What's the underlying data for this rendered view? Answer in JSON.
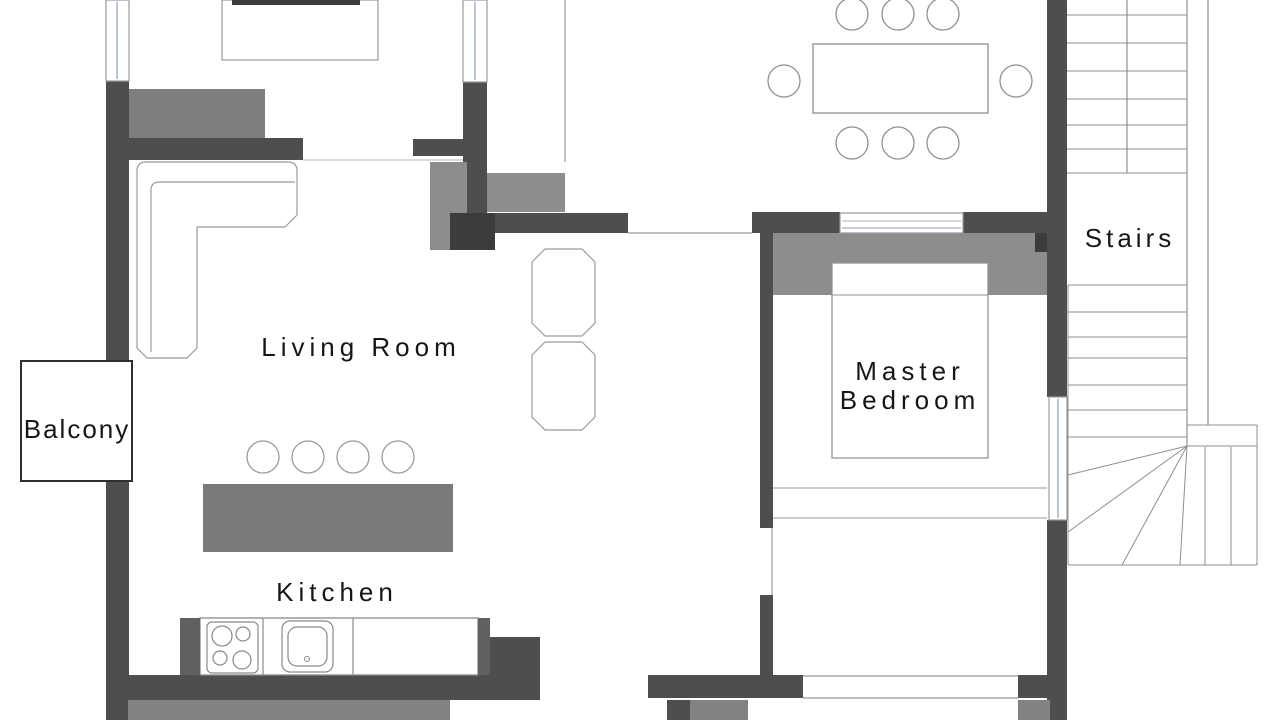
{
  "meta": {
    "width": 1280,
    "height": 720,
    "background": "#ffffff",
    "type": "architectural-floor-plan"
  },
  "rooms": [
    "Living Room",
    "Balcony",
    "Kitchen",
    "Master Bedroom",
    "Stairs"
  ],
  "colors": {
    "wall": "#4e4e4e",
    "wall_dark": "#3c3c3c",
    "furniture_gray": "#8d8d8d",
    "outline": "#9a9a9a",
    "window_glass": "#9fb0d8",
    "text": "#161616"
  },
  "labels": {
    "living_room": "Living Room",
    "balcony": "Balcony",
    "kitchen": "Kitchen",
    "master_bedroom_line1": "Master",
    "master_bedroom_line2": "Bedroom",
    "stairs": "Stairs"
  },
  "shapes": [
    {
      "t": "rect",
      "n": "sideboard",
      "x": 129,
      "y": 89,
      "w": 136,
      "h": 49,
      "f": "#7e7e7e"
    },
    {
      "t": "rect",
      "n": "wall-left-upper",
      "x": 106,
      "y": 81,
      "w": 23,
      "h": 280,
      "f": "#4e4e4e"
    },
    {
      "t": "rect",
      "n": "wall-left-lower",
      "x": 106,
      "y": 481,
      "w": 23,
      "h": 239,
      "f": "#4e4e4e"
    },
    {
      "t": "rect",
      "n": "wall-top-left-horizontal",
      "x": 129,
      "y": 138,
      "w": 174,
      "h": 22,
      "f": "#4e4e4e"
    },
    {
      "t": "rect",
      "n": "wall-entry-stub",
      "x": 413,
      "y": 139,
      "w": 65,
      "h": 17,
      "f": "#4e4e4e"
    },
    {
      "t": "rect",
      "n": "wall-window-column",
      "x": 463,
      "y": 82,
      "w": 24,
      "h": 131,
      "f": "#4e4e4e"
    },
    {
      "t": "rect",
      "n": "cabinet-junction-left",
      "x": 430,
      "y": 162,
      "w": 37,
      "h": 88,
      "f": "#8d8d8d"
    },
    {
      "t": "rect",
      "n": "cabinet-junction-top",
      "x": 487,
      "y": 173,
      "w": 78,
      "h": 39,
      "f": "#8d8d8d"
    },
    {
      "t": "rect",
      "n": "wall-center-bar",
      "x": 450,
      "y": 213,
      "w": 178,
      "h": 20,
      "f": "#4e4e4e"
    },
    {
      "t": "rect",
      "n": "wall-center-pier",
      "x": 450,
      "y": 213,
      "w": 45,
      "h": 37,
      "f": "#3c3c3c"
    },
    {
      "t": "rect",
      "n": "wall-dining-right",
      "x": 1047,
      "y": 0,
      "w": 20,
      "h": 233,
      "f": "#4e4e4e"
    },
    {
      "t": "rect",
      "n": "wall-bedroom-top-left",
      "x": 752,
      "y": 212,
      "w": 88,
      "h": 21,
      "f": "#4e4e4e"
    },
    {
      "t": "rect",
      "n": "wall-bedroom-top-right",
      "x": 963,
      "y": 212,
      "w": 104,
      "h": 21,
      "f": "#4e4e4e"
    },
    {
      "t": "rect",
      "n": "wardrobe-headboard",
      "x": 773,
      "y": 233,
      "w": 275,
      "h": 62,
      "f": "#8d8d8d"
    },
    {
      "t": "rect",
      "n": "wall-headboard-pier",
      "x": 1035,
      "y": 233,
      "w": 15,
      "h": 19,
      "f": "#3c3c3c"
    },
    {
      "t": "rect",
      "n": "wall-bedroom-left-upper",
      "x": 760,
      "y": 233,
      "w": 13,
      "h": 295,
      "f": "#4e4e4e"
    },
    {
      "t": "rect",
      "n": "wall-bedroom-left-lower",
      "x": 760,
      "y": 595,
      "w": 13,
      "h": 80,
      "f": "#4e4e4e"
    },
    {
      "t": "rect",
      "n": "wall-right-mid",
      "x": 1047,
      "y": 233,
      "w": 20,
      "h": 164,
      "f": "#4e4e4e"
    },
    {
      "t": "rect",
      "n": "wall-right-lower",
      "x": 1047,
      "y": 520,
      "w": 20,
      "h": 200,
      "f": "#4e4e4e"
    },
    {
      "t": "rect",
      "n": "wall-bottom-bedroom-left",
      "x": 648,
      "y": 675,
      "w": 155,
      "h": 23,
      "f": "#4e4e4e"
    },
    {
      "t": "rect",
      "n": "wall-bottom-bedroom-right",
      "x": 1018,
      "y": 675,
      "w": 49,
      "h": 23,
      "f": "#4e4e4e"
    },
    {
      "t": "rect",
      "n": "wall-bottom-kitchen",
      "x": 106,
      "y": 675,
      "w": 434,
      "h": 25,
      "f": "#4e4e4e"
    },
    {
      "t": "rect",
      "n": "wall-kitchen-jog",
      "x": 488,
      "y": 637,
      "w": 52,
      "h": 60,
      "f": "#4e4e4e"
    },
    {
      "t": "rect",
      "n": "wall-gray-band-kitchen",
      "x": 128,
      "y": 700,
      "w": 322,
      "h": 20,
      "f": "#828282"
    },
    {
      "t": "rect",
      "n": "wall-stub-dark",
      "x": 667,
      "y": 700,
      "w": 23,
      "h": 20,
      "f": "#4e4e4e"
    },
    {
      "t": "rect",
      "n": "wall-stub-gray",
      "x": 690,
      "y": 700,
      "w": 58,
      "h": 20,
      "f": "#828282"
    },
    {
      "t": "rect",
      "n": "wall-stub-gray-right",
      "x": 1018,
      "y": 700,
      "w": 32,
      "h": 20,
      "f": "#828282"
    },
    {
      "t": "rect",
      "n": "window-left",
      "x": 106,
      "y": 0,
      "w": 23,
      "h": 81,
      "f": "#ffffff",
      "s": "#9a9a9a",
      "sw": 1.2
    },
    {
      "t": "line",
      "n": "window-left-glass-line",
      "x1": 117,
      "y1": 2,
      "x2": 117,
      "y2": 79,
      "s": "#9fb0d8",
      "sw": 1.5
    },
    {
      "t": "rect",
      "n": "window-top-center",
      "x": 463,
      "y": 0,
      "w": 24,
      "h": 82,
      "f": "#ffffff",
      "s": "#9a9a9a",
      "sw": 1.2
    },
    {
      "t": "line",
      "n": "window-top-center-glass-line",
      "x1": 475,
      "y1": 2,
      "x2": 475,
      "y2": 80,
      "s": "#9fb0d8",
      "sw": 1.5
    },
    {
      "t": "rect",
      "n": "window-bedroom-top",
      "x": 840,
      "y": 213,
      "w": 123,
      "h": 20,
      "f": "#ffffff",
      "s": "#9a9a9a",
      "sw": 1.2
    },
    {
      "t": "line",
      "n": "window-bedroom-top-line",
      "x1": 842,
      "y1": 221,
      "x2": 961,
      "y2": 221,
      "s": "#b0b0b0",
      "sw": 1
    },
    {
      "t": "line",
      "n": "window-bedroom-top-glass-line",
      "x1": 842,
      "y1": 228,
      "x2": 961,
      "y2": 228,
      "s": "#9fb0d8",
      "sw": 1.2
    },
    {
      "t": "rect",
      "n": "window-right",
      "x": 1049,
      "y": 397,
      "w": 18,
      "h": 123,
      "f": "#ffffff",
      "s": "#9a9a9a",
      "sw": 1.2
    },
    {
      "t": "line",
      "n": "window-right-glass-line",
      "x1": 1058,
      "y1": 399,
      "x2": 1058,
      "y2": 518,
      "s": "#9fb0d8",
      "sw": 1.5
    },
    {
      "t": "rect",
      "n": "balcony-outline",
      "x": 21,
      "y": 361,
      "w": 111,
      "h": 120,
      "f": "#ffffff",
      "s": "#2f2f2f",
      "sw": 2
    },
    {
      "t": "line",
      "n": "divider-living-dining",
      "x1": 565,
      "y1": 0,
      "x2": 565,
      "y2": 162,
      "s": "#9a9a9a",
      "sw": 1.2
    },
    {
      "t": "line",
      "n": "opening-top-line",
      "x1": 303,
      "y1": 160,
      "x2": 463,
      "y2": 160,
      "s": "#b5b5b5",
      "sw": 1
    },
    {
      "t": "line",
      "n": "doorway-dining-line",
      "x1": 628,
      "y1": 233,
      "x2": 752,
      "y2": 233,
      "s": "#9a9a9a",
      "sw": 1.2
    },
    {
      "t": "line",
      "n": "door-bedroom-line",
      "x1": 772,
      "y1": 528,
      "x2": 772,
      "y2": 595,
      "s": "#9a9a9a",
      "sw": 1.2
    },
    {
      "t": "line",
      "n": "door-bottom-top-line",
      "x1": 803,
      "y1": 676,
      "x2": 1018,
      "y2": 676,
      "s": "#9a9a9a",
      "sw": 1.2
    },
    {
      "t": "line",
      "n": "door-bottom-bottom-line",
      "x1": 803,
      "y1": 698,
      "x2": 1018,
      "y2": 698,
      "s": "#9a9a9a",
      "sw": 1.2
    },
    {
      "t": "rect",
      "n": "tv-stand",
      "x": 222,
      "y": 0,
      "w": 156,
      "h": 60,
      "f": "#ffffff",
      "s": "#9a9a9a",
      "sw": 1.2
    },
    {
      "t": "rect",
      "n": "tv",
      "x": 232,
      "y": 0,
      "w": 128,
      "h": 5,
      "f": "#3c3c3c"
    },
    {
      "t": "path",
      "n": "sofa-outline",
      "d": "M 137 171 Q 137 162 146 162 L 288 162 Q 297 162 297 171 L 297 215 L 285 227 L 197 227 L 197 348 L 187 358 L 147 358 L 137 348 Z",
      "f": "#ffffff",
      "s": "#9a9a9a",
      "sw": 1.2
    },
    {
      "t": "path",
      "n": "sofa-backrest-line",
      "d": "M 151 352 L 151 190 Q 151 182 160 182 L 295 182",
      "f": "none",
      "s": "#9a9a9a",
      "sw": 1.2
    },
    {
      "t": "path",
      "n": "lounge-chair-1",
      "d": "M 532 262 L 545 249 L 582 249 L 595 262 L 595 323 L 582 336 L 545 336 L 532 323 Z",
      "f": "#ffffff",
      "s": "#9a9a9a",
      "sw": 1.2
    },
    {
      "t": "path",
      "n": "lounge-chair-2",
      "d": "M 532 355 L 545 342 L 582 342 L 595 355 L 595 417 L 582 430 L 545 430 L 532 417 Z",
      "f": "#ffffff",
      "s": "#9a9a9a",
      "sw": 1.2
    },
    {
      "t": "rect",
      "n": "kitchen-island",
      "x": 203,
      "y": 484,
      "w": 250,
      "h": 68,
      "f": "#7a7a7a"
    },
    {
      "t": "circle",
      "n": "bar-stool-1",
      "cx": 263,
      "cy": 457,
      "r": 16,
      "f": "#ffffff",
      "s": "#9a9a9a",
      "sw": 1.3
    },
    {
      "t": "circle",
      "n": "bar-stool-2",
      "cx": 308,
      "cy": 457,
      "r": 16,
      "f": "#ffffff",
      "s": "#9a9a9a",
      "sw": 1.3
    },
    {
      "t": "circle",
      "n": "bar-stool-3",
      "cx": 353,
      "cy": 457,
      "r": 16,
      "f": "#ffffff",
      "s": "#9a9a9a",
      "sw": 1.3
    },
    {
      "t": "circle",
      "n": "bar-stool-4",
      "cx": 398,
      "cy": 457,
      "r": 16,
      "f": "#ffffff",
      "s": "#9a9a9a",
      "sw": 1.3
    },
    {
      "t": "rect",
      "n": "kitchen-counter",
      "x": 200,
      "y": 618,
      "w": 278,
      "h": 57,
      "f": "#ffffff",
      "s": "#8a8a8a",
      "sw": 1.3
    },
    {
      "t": "rect",
      "n": "counter-end-left",
      "x": 180,
      "y": 618,
      "w": 20,
      "h": 57,
      "f": "#606060"
    },
    {
      "t": "rect",
      "n": "counter-end-right",
      "x": 478,
      "y": 618,
      "w": 12,
      "h": 57,
      "f": "#606060"
    },
    {
      "t": "line",
      "n": "counter-divider-1",
      "x1": 263,
      "y1": 618,
      "x2": 263,
      "y2": 675,
      "s": "#8a8a8a",
      "sw": 1.2
    },
    {
      "t": "line",
      "n": "counter-divider-2",
      "x1": 353,
      "y1": 618,
      "x2": 353,
      "y2": 675,
      "s": "#8a8a8a",
      "sw": 1.2
    },
    {
      "t": "rect",
      "n": "stove",
      "x": 207,
      "y": 622,
      "w": 51,
      "h": 51,
      "rx": 5,
      "f": "#ffffff",
      "s": "#8a8a8a",
      "sw": 1.2
    },
    {
      "t": "circle",
      "n": "stove-burner-1",
      "cx": 222,
      "cy": 636,
      "r": 10,
      "f": "none",
      "s": "#8a8a8a",
      "sw": 1.2
    },
    {
      "t": "circle",
      "n": "stove-burner-2",
      "cx": 243,
      "cy": 634,
      "r": 7,
      "f": "none",
      "s": "#8a8a8a",
      "sw": 1.2
    },
    {
      "t": "circle",
      "n": "stove-burner-3",
      "cx": 220,
      "cy": 658,
      "r": 7,
      "f": "none",
      "s": "#8a8a8a",
      "sw": 1.2
    },
    {
      "t": "circle",
      "n": "stove-burner-4",
      "cx": 242,
      "cy": 660,
      "r": 9,
      "f": "none",
      "s": "#8a8a8a",
      "sw": 1.2
    },
    {
      "t": "rect",
      "n": "sink",
      "x": 282,
      "y": 621,
      "w": 51,
      "h": 51,
      "rx": 8,
      "f": "#ffffff",
      "s": "#8a8a8a",
      "sw": 1.2
    },
    {
      "t": "rect",
      "n": "sink-basin",
      "x": 288,
      "y": 627,
      "w": 39,
      "h": 39,
      "rx": 9,
      "f": "none",
      "s": "#8a8a8a",
      "sw": 1.2
    },
    {
      "t": "circle",
      "n": "sink-faucet",
      "cx": 307,
      "cy": 659,
      "r": 2.5,
      "f": "none",
      "s": "#8a8a8a",
      "sw": 1
    },
    {
      "t": "rect",
      "n": "dining-table",
      "x": 813,
      "y": 44,
      "w": 175,
      "h": 69,
      "f": "#ffffff",
      "s": "#8f8f8f",
      "sw": 1.3
    },
    {
      "t": "circle",
      "n": "dining-chair-top-1",
      "cx": 852,
      "cy": 14,
      "r": 16,
      "f": "#ffffff",
      "s": "#8f8f8f",
      "sw": 1.3
    },
    {
      "t": "circle",
      "n": "dining-chair-top-2",
      "cx": 898,
      "cy": 14,
      "r": 16,
      "f": "#ffffff",
      "s": "#8f8f8f",
      "sw": 1.3
    },
    {
      "t": "circle",
      "n": "dining-chair-top-3",
      "cx": 943,
      "cy": 14,
      "r": 16,
      "f": "#ffffff",
      "s": "#8f8f8f",
      "sw": 1.3
    },
    {
      "t": "circle",
      "n": "dining-chair-left",
      "cx": 784,
      "cy": 81,
      "r": 16,
      "f": "#ffffff",
      "s": "#8f8f8f",
      "sw": 1.3
    },
    {
      "t": "circle",
      "n": "dining-chair-right",
      "cx": 1016,
      "cy": 81,
      "r": 16,
      "f": "#ffffff",
      "s": "#8f8f8f",
      "sw": 1.3
    },
    {
      "t": "circle",
      "n": "dining-chair-bottom-1",
      "cx": 852,
      "cy": 143,
      "r": 16,
      "f": "#ffffff",
      "s": "#8f8f8f",
      "sw": 1.3
    },
    {
      "t": "circle",
      "n": "dining-chair-bottom-2",
      "cx": 898,
      "cy": 143,
      "r": 16,
      "f": "#ffffff",
      "s": "#8f8f8f",
      "sw": 1.3
    },
    {
      "t": "circle",
      "n": "dining-chair-bottom-3",
      "cx": 943,
      "cy": 143,
      "r": 16,
      "f": "#ffffff",
      "s": "#8f8f8f",
      "sw": 1.3
    },
    {
      "t": "rect",
      "n": "bed",
      "x": 832,
      "y": 263,
      "w": 156,
      "h": 195,
      "f": "#ffffff",
      "s": "#8f8f8f",
      "sw": 1.2
    },
    {
      "t": "line",
      "n": "bed-pillow-line",
      "x1": 832,
      "y1": 295,
      "x2": 988,
      "y2": 295,
      "s": "#8f8f8f",
      "sw": 1
    },
    {
      "t": "line",
      "n": "bedroom-bench-top-line",
      "x1": 773,
      "y1": 488,
      "x2": 1047,
      "y2": 488,
      "s": "#9a9a9a",
      "sw": 1
    },
    {
      "t": "line",
      "n": "bedroom-bench-bottom-line",
      "x1": 773,
      "y1": 518,
      "x2": 1047,
      "y2": 518,
      "s": "#9a9a9a",
      "sw": 1
    },
    {
      "t": "line",
      "n": "stairs-right-boundary",
      "x1": 1187,
      "y1": 0,
      "x2": 1187,
      "y2": 446,
      "s": "#8f8f8f",
      "sw": 1.2
    },
    {
      "t": "line",
      "n": "stairs-center-divider",
      "x1": 1127,
      "y1": 0,
      "x2": 1127,
      "y2": 173,
      "s": "#8f8f8f",
      "sw": 1.2
    },
    {
      "t": "line",
      "n": "stairs-tread-u1",
      "x1": 1067,
      "y1": 15,
      "x2": 1187,
      "y2": 15,
      "s": "#8f8f8f",
      "sw": 1
    },
    {
      "t": "line",
      "n": "stairs-tread-u2",
      "x1": 1067,
      "y1": 43,
      "x2": 1187,
      "y2": 43,
      "s": "#8f8f8f",
      "sw": 1
    },
    {
      "t": "line",
      "n": "stairs-tread-u3",
      "x1": 1067,
      "y1": 71,
      "x2": 1187,
      "y2": 71,
      "s": "#8f8f8f",
      "sw": 1
    },
    {
      "t": "line",
      "n": "stairs-tread-u4",
      "x1": 1067,
      "y1": 99,
      "x2": 1187,
      "y2": 99,
      "s": "#8f8f8f",
      "sw": 1
    },
    {
      "t": "line",
      "n": "stairs-tread-u5",
      "x1": 1067,
      "y1": 125,
      "x2": 1187,
      "y2": 125,
      "s": "#8f8f8f",
      "sw": 1
    },
    {
      "t": "line",
      "n": "stairs-tread-u6",
      "x1": 1067,
      "y1": 149,
      "x2": 1187,
      "y2": 149,
      "s": "#8f8f8f",
      "sw": 1
    },
    {
      "t": "line",
      "n": "stairs-tread-u7",
      "x1": 1067,
      "y1": 173,
      "x2": 1187,
      "y2": 173,
      "s": "#8f8f8f",
      "sw": 1
    },
    {
      "t": "line",
      "n": "stairs-outer-line",
      "x1": 1208,
      "y1": 0,
      "x2": 1208,
      "y2": 425,
      "s": "#8f8f8f",
      "sw": 1.2
    },
    {
      "t": "line",
      "n": "stairs-tread-l1",
      "x1": 1068,
      "y1": 285,
      "x2": 1187,
      "y2": 285,
      "s": "#8f8f8f",
      "sw": 1
    },
    {
      "t": "line",
      "n": "stairs-tread-l2",
      "x1": 1068,
      "y1": 312,
      "x2": 1187,
      "y2": 312,
      "s": "#8f8f8f",
      "sw": 1
    },
    {
      "t": "line",
      "n": "stairs-tread-l3",
      "x1": 1068,
      "y1": 337,
      "x2": 1187,
      "y2": 337,
      "s": "#8f8f8f",
      "sw": 1
    },
    {
      "t": "line",
      "n": "stairs-tread-l4",
      "x1": 1068,
      "y1": 358,
      "x2": 1187,
      "y2": 358,
      "s": "#8f8f8f",
      "sw": 1
    },
    {
      "t": "line",
      "n": "stairs-tread-l5",
      "x1": 1068,
      "y1": 385,
      "x2": 1187,
      "y2": 385,
      "s": "#8f8f8f",
      "sw": 1
    },
    {
      "t": "line",
      "n": "stairs-tread-l6",
      "x1": 1068,
      "y1": 410,
      "x2": 1187,
      "y2": 410,
      "s": "#8f8f8f",
      "sw": 1
    },
    {
      "t": "line",
      "n": "stairs-tread-l7",
      "x1": 1068,
      "y1": 437,
      "x2": 1187,
      "y2": 437,
      "s": "#8f8f8f",
      "sw": 1
    },
    {
      "t": "line",
      "n": "stairs-left-boundary",
      "x1": 1068,
      "y1": 285,
      "x2": 1068,
      "y2": 565,
      "s": "#8f8f8f",
      "sw": 1
    },
    {
      "t": "line",
      "n": "stairs-landing-top",
      "x1": 1187,
      "y1": 425,
      "x2": 1257,
      "y2": 425,
      "s": "#8f8f8f",
      "sw": 1
    },
    {
      "t": "line",
      "n": "stairs-landing-bottom",
      "x1": 1187,
      "y1": 446,
      "x2": 1257,
      "y2": 446,
      "s": "#8f8f8f",
      "sw": 1
    },
    {
      "t": "line",
      "n": "stairs-landing-right",
      "x1": 1257,
      "y1": 425,
      "x2": 1257,
      "y2": 565,
      "s": "#8f8f8f",
      "sw": 1
    },
    {
      "t": "line",
      "n": "stairs-bottom-boundary",
      "x1": 1068,
      "y1": 565,
      "x2": 1257,
      "y2": 565,
      "s": "#8f8f8f",
      "sw": 1
    },
    {
      "t": "line",
      "n": "stairs-winder-1",
      "x1": 1187,
      "y1": 446,
      "x2": 1068,
      "y2": 475,
      "s": "#8f8f8f",
      "sw": 1
    },
    {
      "t": "line",
      "n": "stairs-winder-2",
      "x1": 1187,
      "y1": 446,
      "x2": 1068,
      "y2": 532,
      "s": "#8f8f8f",
      "sw": 1
    },
    {
      "t": "line",
      "n": "stairs-winder-3",
      "x1": 1187,
      "y1": 446,
      "x2": 1122,
      "y2": 565,
      "s": "#8f8f8f",
      "sw": 1
    },
    {
      "t": "line",
      "n": "stairs-winder-4",
      "x1": 1187,
      "y1": 446,
      "x2": 1180,
      "y2": 565,
      "s": "#8f8f8f",
      "sw": 1
    },
    {
      "t": "line",
      "n": "stairs-winder-5",
      "x1": 1205,
      "y1": 447,
      "x2": 1205,
      "y2": 565,
      "s": "#8f8f8f",
      "sw": 1
    },
    {
      "t": "line",
      "n": "stairs-winder-6",
      "x1": 1231,
      "y1": 447,
      "x2": 1231,
      "y2": 565,
      "s": "#8f8f8f",
      "sw": 1
    },
    {
      "t": "text",
      "n": "living-room-label",
      "text": "Living Room",
      "x": 361,
      "y": 356,
      "size": 26,
      "ls": 5
    },
    {
      "t": "text",
      "n": "balcony-label",
      "text": "Balcony",
      "x": 77,
      "y": 438,
      "size": 26,
      "ls": 2
    },
    {
      "t": "text",
      "n": "kitchen-label",
      "text": "Kitchen",
      "x": 337,
      "y": 601,
      "size": 26,
      "ls": 5
    },
    {
      "t": "text",
      "n": "master-bedroom-label-line1",
      "text": "Master",
      "x": 910,
      "y": 380,
      "size": 26,
      "ls": 5
    },
    {
      "t": "text",
      "n": "master-bedroom-label-line2",
      "text": "Bedroom",
      "x": 910,
      "y": 409,
      "size": 26,
      "ls": 5
    },
    {
      "t": "text",
      "n": "stairs-label",
      "text": "Stairs",
      "x": 1130,
      "y": 247,
      "size": 26,
      "ls": 4
    }
  ]
}
